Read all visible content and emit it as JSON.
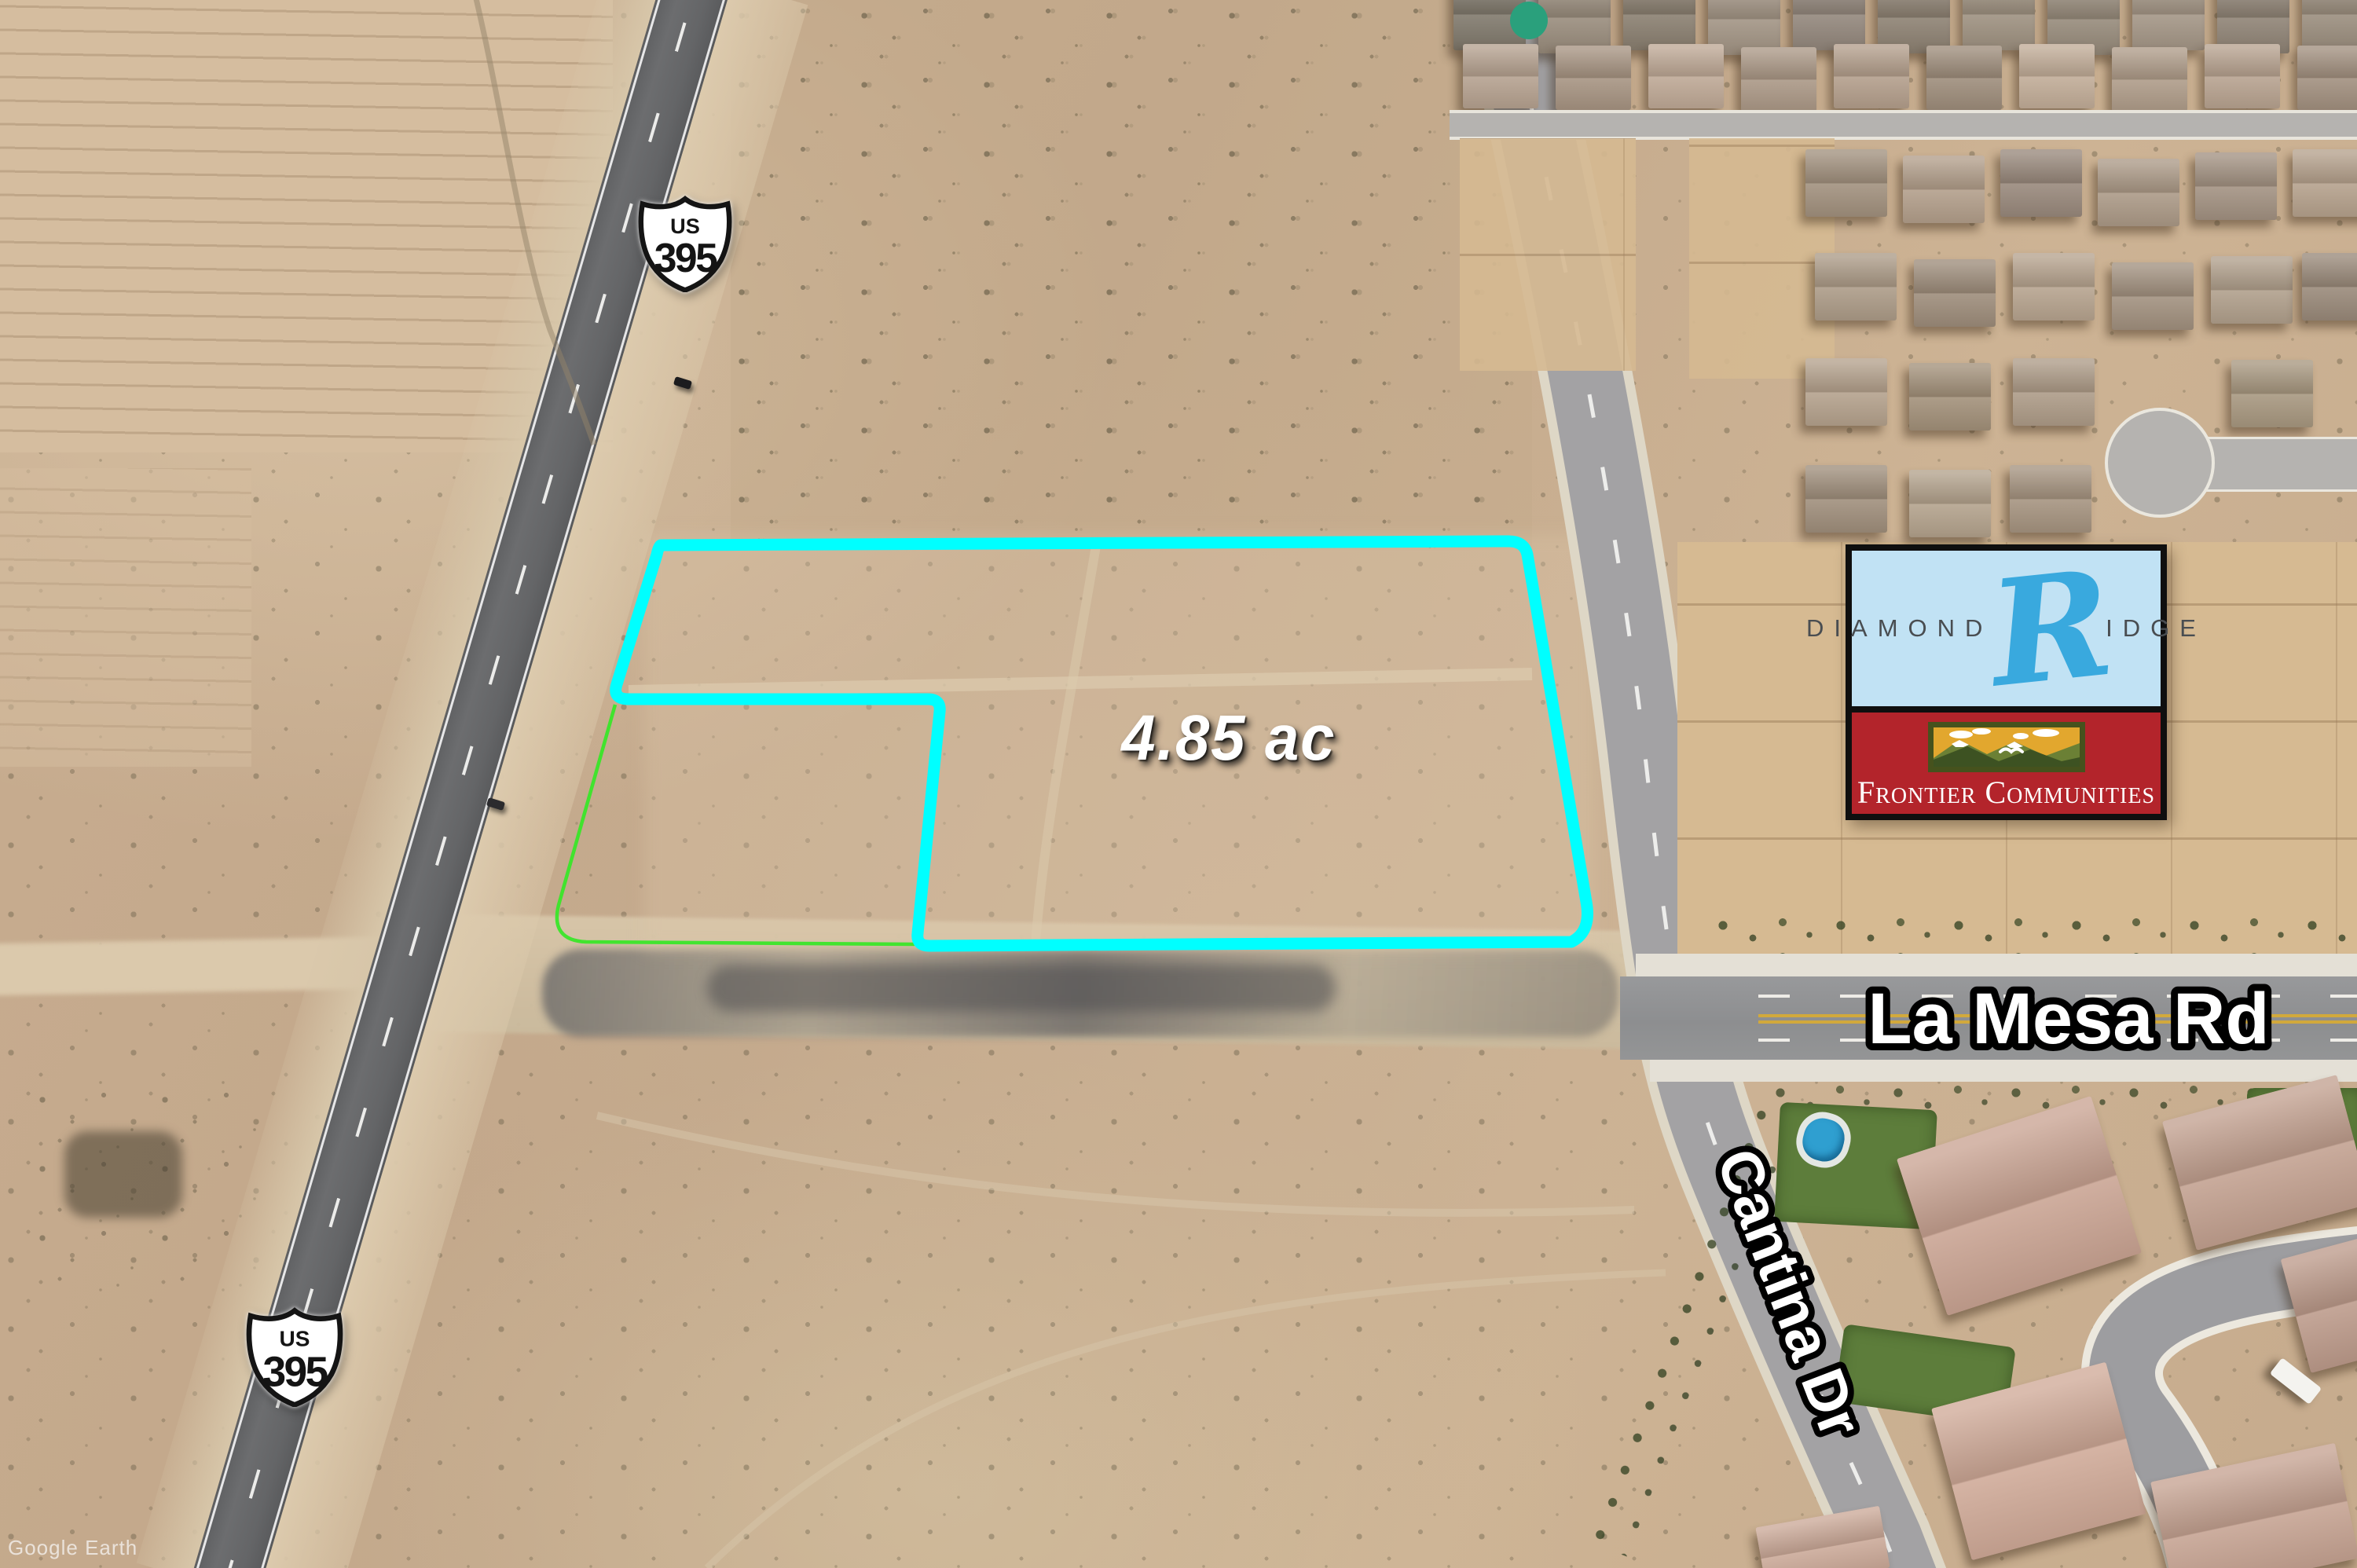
{
  "map": {
    "watermark": "Google Earth",
    "parcel": {
      "area_label": "4.85 ac",
      "outline_color": "#00ffff",
      "inner_boundary_color": "#3ae629"
    },
    "roads": {
      "la_mesa": "La Mesa Rd",
      "cantina": "Cantina Dr"
    },
    "shields": [
      {
        "system": "US",
        "number": "395"
      },
      {
        "system": "US",
        "number": "395"
      }
    ],
    "sign": {
      "top": {
        "left_text": "DIAMOND",
        "initial": "R",
        "right_text": "IDGE",
        "bg": "#c1e2f4",
        "initial_color": "#39a9de"
      },
      "bottom": {
        "text": "Frontier Communities",
        "bg": "#b3242b"
      }
    }
  }
}
